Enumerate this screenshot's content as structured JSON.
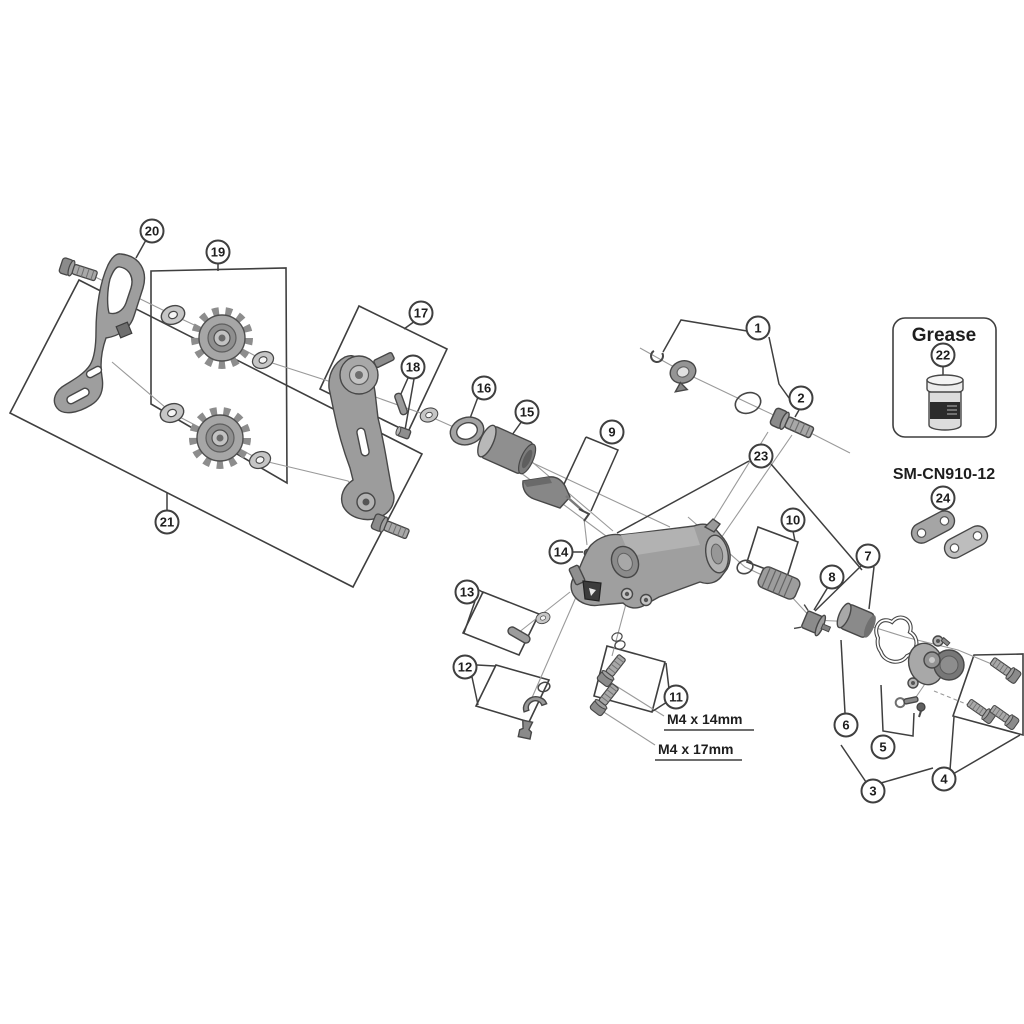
{
  "figure": {
    "type": "exploded-parts-diagram",
    "subject": "rear derailleur exploded view",
    "background_color": "#ffffff",
    "line_color": "#3f3f3f",
    "part_fill_color": "#9e9e9e",
    "labels": {
      "grease_box_title": "Grease",
      "chain_connector_model": "SM-CN910-12",
      "bolt_spec_14mm": "M4 x 14mm",
      "bolt_spec_17mm": "M4 x 17mm"
    },
    "callouts": [
      {
        "n": "1",
        "x": 758,
        "y": 328
      },
      {
        "n": "2",
        "x": 801,
        "y": 398
      },
      {
        "n": "3",
        "x": 873,
        "y": 791
      },
      {
        "n": "4",
        "x": 944,
        "y": 779
      },
      {
        "n": "5",
        "x": 883,
        "y": 747
      },
      {
        "n": "6",
        "x": 846,
        "y": 725
      },
      {
        "n": "7",
        "x": 868,
        "y": 556
      },
      {
        "n": "8",
        "x": 832,
        "y": 577
      },
      {
        "n": "9",
        "x": 612,
        "y": 432
      },
      {
        "n": "10",
        "x": 793,
        "y": 520
      },
      {
        "n": "11",
        "x": 676,
        "y": 697
      },
      {
        "n": "12",
        "x": 465,
        "y": 667
      },
      {
        "n": "13",
        "x": 467,
        "y": 592
      },
      {
        "n": "14",
        "x": 561,
        "y": 552
      },
      {
        "n": "15",
        "x": 527,
        "y": 412
      },
      {
        "n": "16",
        "x": 484,
        "y": 388
      },
      {
        "n": "17",
        "x": 421,
        "y": 313
      },
      {
        "n": "18",
        "x": 413,
        "y": 367
      },
      {
        "n": "19",
        "x": 218,
        "y": 252
      },
      {
        "n": "20",
        "x": 152,
        "y": 231
      },
      {
        "n": "21",
        "x": 167,
        "y": 522
      },
      {
        "n": "22",
        "x": 943,
        "y": 355
      },
      {
        "n": "23",
        "x": 761,
        "y": 456
      },
      {
        "n": "24",
        "x": 943,
        "y": 498
      }
    ]
  }
}
